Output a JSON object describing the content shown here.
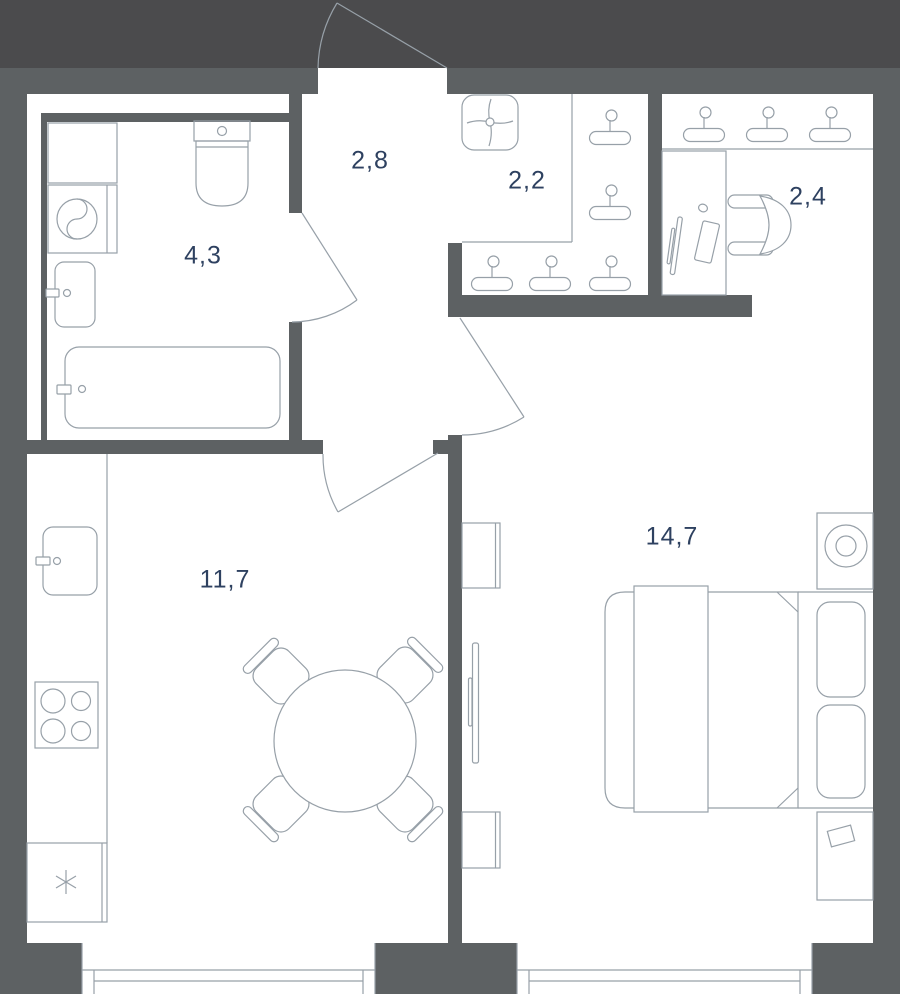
{
  "floorplan": {
    "rooms": [
      {
        "name": "bathroom",
        "area": "4,3"
      },
      {
        "name": "hallway",
        "area": "2,8"
      },
      {
        "name": "wardrobe",
        "area": "2,2"
      },
      {
        "name": "workspace-niche",
        "area": "2,4"
      },
      {
        "name": "kitchen-living-room",
        "area": "11,7"
      },
      {
        "name": "bedroom",
        "area": "14,7"
      }
    ],
    "colors": {
      "outside_background": "#4b4b4d",
      "wall": "#5d6163",
      "floor": "#ffffff",
      "drawing_line": "#97a0a8",
      "label_text": "#2e4160"
    },
    "icons": [
      "hanger-icon",
      "ceiling-fan-icon",
      "freezer-snowflake-icon"
    ]
  }
}
